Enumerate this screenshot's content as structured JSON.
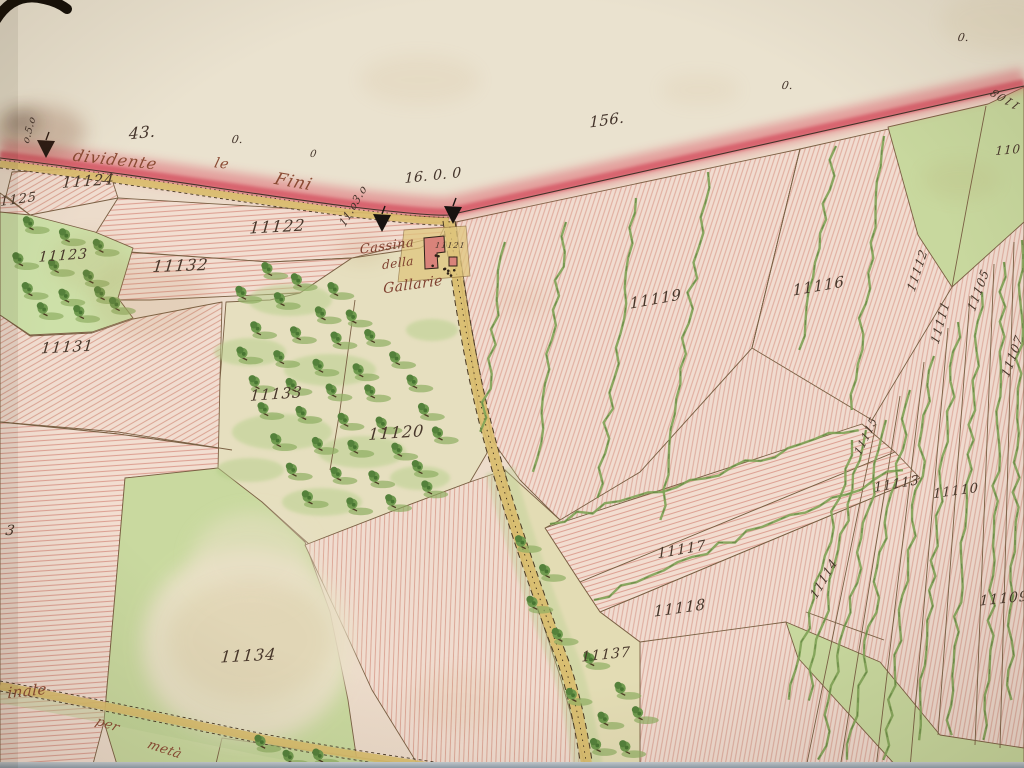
{
  "map": {
    "description": "Hand-drawn 19th-century cadastral watercolour map photographed at an angle; red-washed territorial boundary across the top, yellow roads, pink hatched fields, green meadows, tree orchards and vineyard strips",
    "colors": {
      "paper_outside": "#eae2cf",
      "paper_inside": "#eddccb",
      "boundary_red": "#dc5a68",
      "road_yellow": "#d9bc6c",
      "meadow_green": "#c9d99f",
      "vine_green": "#7fa355",
      "ink_brown": "#47362a",
      "script_red_brown": "#8a4a33"
    },
    "annotations": {
      "boundary_script": [
        {
          "text": "dividente",
          "x": 114,
          "y": 165,
          "rot": 6,
          "size": 16
        },
        {
          "text": "le",
          "x": 221,
          "y": 168,
          "rot": 6,
          "size": 14
        },
        {
          "text": "Fini",
          "x": 292,
          "y": 187,
          "rot": 10,
          "size": 17
        }
      ],
      "place_script": [
        {
          "text": "Cassina",
          "x": 387,
          "y": 250,
          "rot": -8,
          "size": 13
        },
        {
          "text": "della",
          "x": 398,
          "y": 267,
          "rot": -8,
          "size": 12
        },
        {
          "text": "Gallarie",
          "x": 413,
          "y": 289,
          "rot": -8,
          "size": 14
        }
      ],
      "road_script": [
        {
          "text": "inale",
          "x": 27,
          "y": 696,
          "rot": -6,
          "size": 15
        },
        {
          "text": "per",
          "x": 106,
          "y": 728,
          "rot": 18,
          "size": 13
        },
        {
          "text": "metà",
          "x": 163,
          "y": 753,
          "rot": 18,
          "size": 13
        }
      ],
      "measurements": [
        {
          "text": "43.",
          "x": 142,
          "y": 138,
          "rot": -6,
          "size": 16
        },
        {
          "text": "156.",
          "x": 607,
          "y": 125,
          "rot": -8,
          "size": 15
        },
        {
          "text": "16. 0. 0",
          "x": 433,
          "y": 180,
          "rot": -6,
          "size": 14
        },
        {
          "text": "0.",
          "x": 237,
          "y": 143,
          "rot": 0,
          "size": 11
        },
        {
          "text": "0",
          "x": 313,
          "y": 157,
          "rot": 0,
          "size": 10
        },
        {
          "text": "0.",
          "x": 787,
          "y": 89,
          "rot": 0,
          "size": 11
        },
        {
          "text": "0.",
          "x": 963,
          "y": 41,
          "rot": 0,
          "size": 11
        },
        {
          "text": "o.5.o",
          "x": 32,
          "y": 131,
          "rot": -75,
          "size": 10
        },
        {
          "text": "11.o3.o",
          "x": 356,
          "y": 208,
          "rot": -60,
          "size": 11
        }
      ],
      "parcel_numbers": [
        {
          "text": "11124",
          "x": 88,
          "y": 186,
          "rot": -4,
          "size": 15
        },
        {
          "text": "11125",
          "x": 14,
          "y": 204,
          "rot": -8,
          "size": 13
        },
        {
          "text": "11123",
          "x": 63,
          "y": 260,
          "rot": -4,
          "size": 14
        },
        {
          "text": "11122",
          "x": 277,
          "y": 232,
          "rot": -3,
          "size": 16
        },
        {
          "text": "11132",
          "x": 180,
          "y": 271,
          "rot": -2,
          "size": 16
        },
        {
          "text": "11131",
          "x": 67,
          "y": 352,
          "rot": -3,
          "size": 15
        },
        {
          "text": "11133",
          "x": 276,
          "y": 399,
          "rot": -4,
          "size": 15
        },
        {
          "text": "11120",
          "x": 396,
          "y": 438,
          "rot": -4,
          "size": 16
        },
        {
          "text": "11134",
          "x": 248,
          "y": 661,
          "rot": -3,
          "size": 16
        },
        {
          "text": "11121",
          "x": 450,
          "y": 248,
          "rot": 0,
          "size": 8
        },
        {
          "text": "11119",
          "x": 656,
          "y": 304,
          "rot": -10,
          "size": 15
        },
        {
          "text": "11116",
          "x": 819,
          "y": 291,
          "rot": -10,
          "size": 15
        },
        {
          "text": "11117",
          "x": 682,
          "y": 554,
          "rot": -10,
          "size": 14
        },
        {
          "text": "11118",
          "x": 680,
          "y": 613,
          "rot": -8,
          "size": 15
        },
        {
          "text": "11137",
          "x": 606,
          "y": 659,
          "rot": -6,
          "size": 14
        },
        {
          "text": "11113",
          "x": 897,
          "y": 488,
          "rot": -10,
          "size": 13
        },
        {
          "text": "11110",
          "x": 956,
          "y": 495,
          "rot": -8,
          "size": 13
        },
        {
          "text": "11109",
          "x": 1004,
          "y": 603,
          "rot": -6,
          "size": 14
        },
        {
          "text": "1108",
          "x": 1007,
          "y": 96,
          "rot": -150,
          "size": 11
        },
        {
          "text": "110",
          "x": 1008,
          "y": 154,
          "rot": -5,
          "size": 12
        },
        {
          "text": "11112",
          "x": 921,
          "y": 272,
          "rot": -72,
          "size": 12
        },
        {
          "text": "11111",
          "x": 944,
          "y": 324,
          "rot": -75,
          "size": 12
        },
        {
          "text": "11105",
          "x": 982,
          "y": 292,
          "rot": -70,
          "size": 12
        },
        {
          "text": "11107",
          "x": 1016,
          "y": 358,
          "rot": -70,
          "size": 12
        },
        {
          "text": "11115",
          "x": 869,
          "y": 438,
          "rot": -65,
          "size": 11
        },
        {
          "text": "11114",
          "x": 827,
          "y": 581,
          "rot": -60,
          "size": 12
        },
        {
          "text": "3",
          "x": 10,
          "y": 535,
          "rot": 0,
          "size": 14
        }
      ]
    }
  }
}
